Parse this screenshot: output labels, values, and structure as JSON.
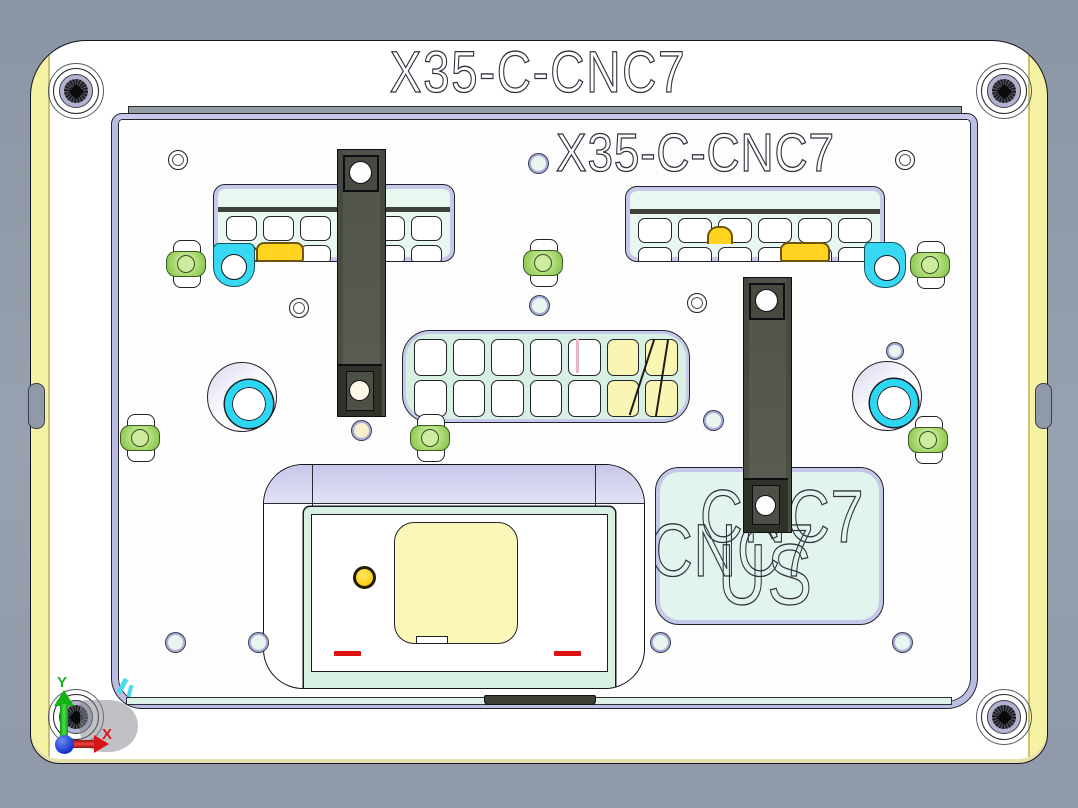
{
  "view": {
    "outer_title": "X35-C-CNC7",
    "inner_title": "X35-C-CNC7",
    "block_engraving": {
      "line1": "CNC7",
      "line2": "US"
    },
    "triad": {
      "x_label": "X",
      "y_label": "Y"
    },
    "colors": {
      "background": "#8f99a9",
      "plate_edge_yellow": "#f6f2a4",
      "mint": "#e2f4ee",
      "lavender": "#b9bde3",
      "cyan_accent": "#36d8f2",
      "amber_pad": "#ffd31f",
      "pale_yellow_part": "#f9f6b4",
      "clamp_bar": "#53564c",
      "toe_clamp_green": "#a8d96e",
      "axis_x_red": "#d81414",
      "axis_y_green": "#12b312",
      "origin_blue": "#1433cc"
    }
  }
}
